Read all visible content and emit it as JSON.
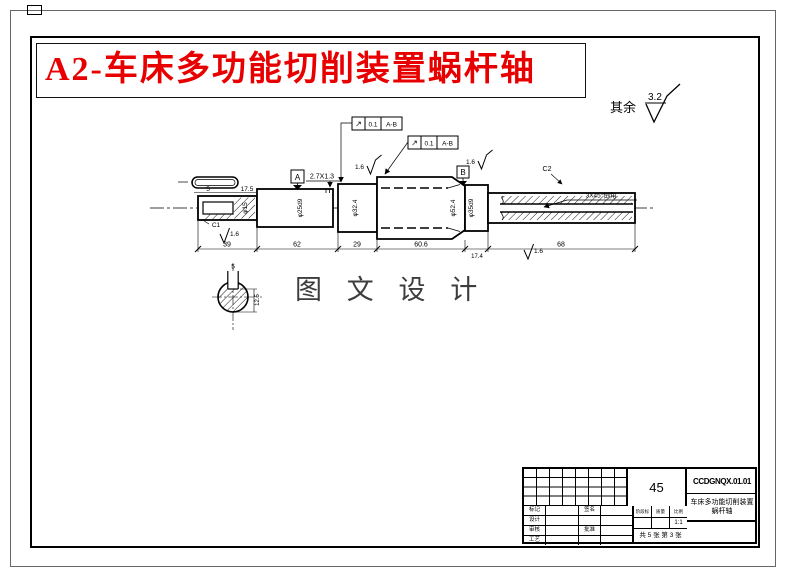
{
  "header": {
    "red_title": "A2-车床多功能切削装置蜗杆轴",
    "surface_default_label": "其余",
    "surface_default_value": "3.2"
  },
  "watermark": "图 文 设 计",
  "drawing": {
    "dims": {
      "len1": "39",
      "len2": "62",
      "len3": "29",
      "len4": "60.6",
      "len5": "17.4",
      "len6": "68"
    },
    "dia": {
      "s1": "φ15",
      "s2": "φ25d9",
      "s3": "φ32.4",
      "s4": "φ52.4",
      "s5": "φ35d9"
    },
    "keyway_top": {
      "width": "5",
      "len": "17.5"
    },
    "groove": "2.7X1.3",
    "chamfer_left": "C1",
    "chamfer_right": "C2",
    "roughness": "1.6",
    "fcf": {
      "sym": "↗",
      "tol": "0.1",
      "datum": "A-B"
    },
    "datum_a": "A",
    "datum_b": "B",
    "note_right": "3X45°倒角",
    "section": {
      "width": "5",
      "depth": "12.5"
    }
  },
  "title_block": {
    "drawing_no": "CCDGNQX.01.01",
    "product": "车床多功能切削装置",
    "part": "蜗杆轴",
    "material": "45",
    "scale": "1:1",
    "sheets": "共 5 张 第 3 张",
    "row_labels": {
      "r1": "标记",
      "r2": "设计",
      "r3": "审核",
      "r4": "工艺"
    },
    "mid_labels": {
      "m1": "签名",
      "m3": "批准"
    },
    "headers": {
      "h1": "阶段标记",
      "h2": "质量",
      "h3": "比例"
    }
  }
}
